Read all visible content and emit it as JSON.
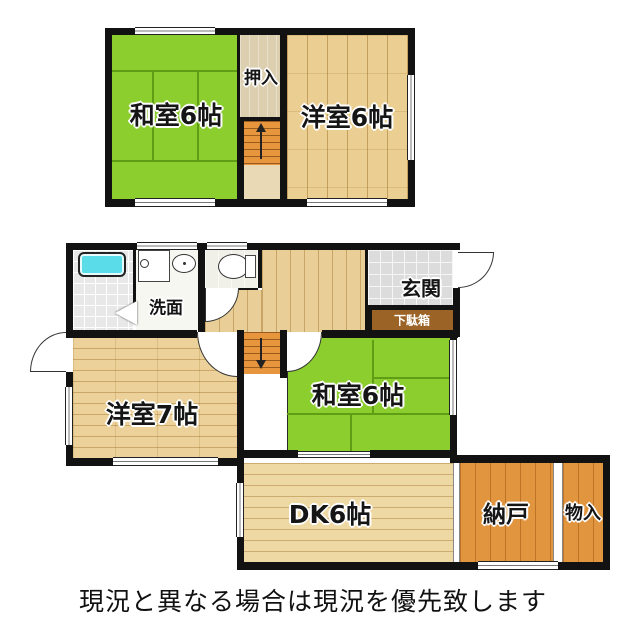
{
  "rooms": {
    "f2_washitsu": {
      "label": "和室6帖"
    },
    "f2_oshiire": {
      "label": "押入"
    },
    "f2_youshitsu": {
      "label": "洋室6帖"
    },
    "f1_senmen": {
      "label": "洗面"
    },
    "f1_genkan": {
      "label": "玄関"
    },
    "f1_getabako": {
      "label": "下駄箱"
    },
    "f1_youshitsu": {
      "label": "洋室7帖"
    },
    "f1_washitsu": {
      "label": "和室6帖"
    },
    "f1_dk": {
      "label": "DK6帖"
    },
    "f1_nando": {
      "label": "納戸"
    },
    "f1_monoire": {
      "label": "物入"
    }
  },
  "note": "現況と異なる場合は現況を優先致します",
  "colors": {
    "tatami_green": "#8bce2e",
    "wood_light": "#ecd29a",
    "storage_orange": "#e2953f",
    "stairs_orange": "#e8963e",
    "bathtub_cyan": "#5bdde9",
    "getabako_brown": "#9b6326",
    "wall": "#121212"
  }
}
